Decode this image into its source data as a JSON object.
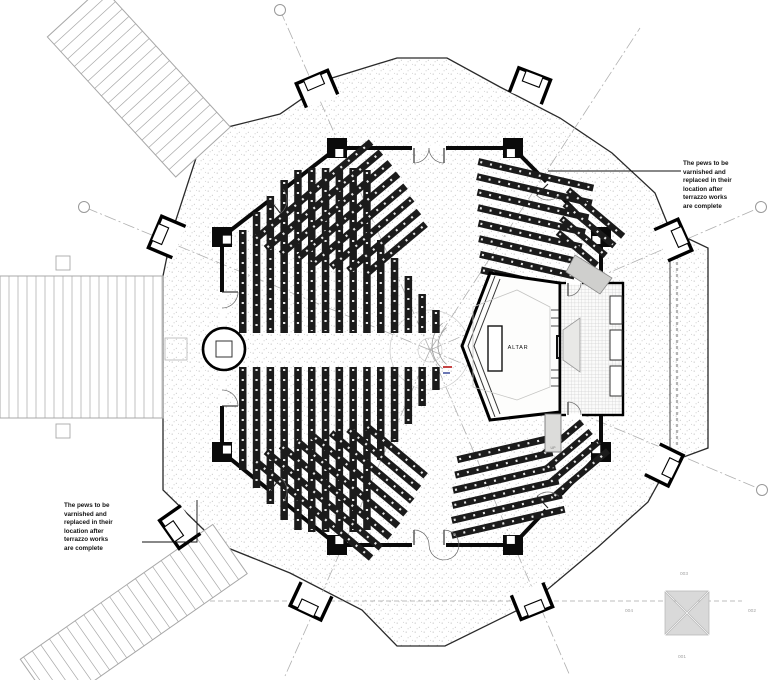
{
  "annotations": {
    "note_top_right": "The pews to be varnished and replaced in their location after terrazzo works are complete",
    "note_bottom_left": "The pews to be varnished and replaced in their location after terrazzo works are complete"
  },
  "labels": {
    "altar": "ALTAR",
    "up": "UP"
  },
  "ref_symbol": {
    "top": "003",
    "right": "002",
    "bottom": "001",
    "left": "004"
  },
  "colors": {
    "wall": "#0a0a0a",
    "outline": "#2a2a2a",
    "pew": "#1b1b1b",
    "stipple_dot": "#8f8f8f",
    "grey_line": "#a8a8a8",
    "dash_line": "#b0b0b0",
    "hatch": "#bcbcbc",
    "red_mark": "#c03030",
    "blue_mark": "#3a4a9a",
    "ref_fill": "#d9d9d9",
    "ref_edge": "#b5b5b5"
  },
  "drawing": {
    "canvas": {
      "w": 769,
      "h": 680
    },
    "center": [
      430,
      350
    ],
    "outer_boundary": [
      [
        397,
        58
      ],
      [
        447,
        58
      ],
      [
        500,
        87
      ],
      [
        560,
        118
      ],
      [
        612,
        153
      ],
      [
        655,
        193
      ],
      [
        670,
        230
      ],
      [
        708,
        248
      ],
      [
        708,
        448
      ],
      [
        670,
        462
      ],
      [
        648,
        502
      ],
      [
        598,
        547
      ],
      [
        548,
        589
      ],
      [
        516,
        611
      ],
      [
        445,
        646
      ],
      [
        397,
        646
      ],
      [
        362,
        610
      ],
      [
        290,
        573
      ],
      [
        228,
        548
      ],
      [
        205,
        531
      ],
      [
        163,
        490
      ],
      [
        163,
        418
      ],
      [
        163,
        276
      ],
      [
        172,
        232
      ],
      [
        197,
        155
      ],
      [
        228,
        127
      ],
      [
        280,
        114
      ],
      [
        332,
        78
      ]
    ],
    "porch_divider": [
      670,
      232,
      670,
      460
    ],
    "glazing_dash": [
      677,
      250,
      677,
      446
    ],
    "inner_octagon": [
      [
        337,
        148
      ],
      [
        513,
        148
      ],
      [
        601,
        237
      ],
      [
        601,
        452
      ],
      [
        513,
        545
      ],
      [
        337,
        545
      ],
      [
        222,
        452
      ],
      [
        222,
        237
      ]
    ],
    "wall_gaps": [
      [
        412,
        148,
        446,
        148
      ],
      [
        412,
        545,
        446,
        545
      ],
      [
        222,
        292,
        222,
        406
      ],
      [
        268,
        202,
        285,
        188
      ],
      [
        546,
        182,
        561,
        197
      ],
      [
        268,
        490,
        285,
        503
      ],
      [
        546,
        510,
        561,
        494
      ],
      [
        566,
        283,
        582,
        283
      ],
      [
        566,
        415,
        582,
        415
      ]
    ],
    "radial_lines": [
      [
        280,
        10
      ],
      [
        84,
        207
      ],
      [
        761,
        207
      ],
      [
        762,
        490
      ],
      [
        570,
        676
      ],
      [
        285,
        676
      ],
      [
        640,
        28
      ]
    ],
    "grid_markers": [
      [
        280,
        10
      ],
      [
        84,
        207
      ],
      [
        761,
        207
      ],
      [
        762,
        490
      ]
    ],
    "section_dash": [
      170,
      601,
      742,
      601
    ],
    "center_circles": [
      40,
      12
    ],
    "chancel_arcs": {
      "cx": 462,
      "cy": 346,
      "radii": [
        24,
        30
      ],
      "a1": 130,
      "a2": 230
    },
    "sanctuary": {
      "outline": [
        [
          462,
          346
        ],
        [
          490,
          273
        ],
        [
          560,
          283
        ],
        [
          560,
          412
        ],
        [
          490,
          420
        ]
      ],
      "steps": [
        [
          [
            495,
            276
          ],
          [
            468,
            346
          ],
          [
            495,
            417
          ]
        ],
        [
          [
            500,
            279
          ],
          [
            474,
            346
          ],
          [
            500,
            414
          ]
        ]
      ],
      "inner_hex": [
        [
          473,
          307
        ],
        [
          517,
          290
        ],
        [
          550,
          307
        ],
        [
          550,
          387
        ],
        [
          517,
          400
        ],
        [
          473,
          387
        ]
      ],
      "altar_rect": [
        488,
        326,
        14,
        45
      ],
      "tabernacle": [
        557,
        336,
        12,
        22
      ],
      "credence": [
        571,
        332,
        14,
        30
      ],
      "step_lines_y": [
        [
          310,
          318,
          326
        ],
        [
          370,
          378,
          386
        ]
      ],
      "marks": {
        "red": [
          443,
          367,
          9
        ],
        "blue": [
          443,
          371,
          7
        ]
      }
    },
    "sacristy": {
      "rect": [
        560,
        283,
        63,
        132
      ],
      "cupboards": [
        [
          610,
          296,
          12,
          28
        ],
        [
          610,
          330,
          12,
          30
        ],
        [
          610,
          366,
          12,
          30
        ]
      ],
      "niche": [
        [
          563,
          330
        ],
        [
          580,
          318
        ],
        [
          580,
          372
        ],
        [
          563,
          360
        ]
      ],
      "organ": [
        [
          575,
          255
        ],
        [
          612,
          278
        ],
        [
          600,
          294
        ],
        [
          566,
          272
        ]
      ],
      "up_ramp": [
        545,
        414,
        16,
        38
      ]
    },
    "font": {
      "cx": 224,
      "cy": 349,
      "r": 21,
      "sq": 16
    },
    "left_stairs": {
      "x": 0,
      "y": 276,
      "w": 163,
      "h": 142,
      "step": 9,
      "posts": [
        [
          56,
          256,
          14
        ],
        [
          56,
          424,
          14
        ]
      ],
      "landing": [
        165,
        338,
        22
      ]
    },
    "rot_stairs": [
      {
        "tx": 203,
        "ty": 152,
        "rot": -132.5,
        "len": 190,
        "halfw": 37,
        "step": 10
      },
      {
        "tx": 230,
        "ty": 549,
        "rot": 145,
        "len": 235,
        "halfw": 30,
        "step": 10.5
      }
    ],
    "vestibules": [
      {
        "x": 317,
        "y": 89,
        "rot": -23
      },
      {
        "x": 530,
        "y": 86,
        "rot": 21
      },
      {
        "x": 167,
        "y": 237,
        "rot": -67
      },
      {
        "x": 673,
        "y": 240,
        "rot": 66
      },
      {
        "x": 180,
        "y": 527,
        "rot": -125
      },
      {
        "x": 664,
        "y": 465,
        "rot": 116
      },
      {
        "x": 311,
        "y": 601,
        "rot": -155
      },
      {
        "x": 532,
        "y": 601,
        "rot": 158
      }
    ],
    "doors": [
      {
        "x": 414,
        "y": 148,
        "a0": 0,
        "a1": 90,
        "r": 15
      },
      {
        "x": 444,
        "y": 148,
        "a0": 180,
        "a1": 90,
        "r": 15
      },
      {
        "x": 414,
        "y": 545,
        "a0": 0,
        "a1": -90,
        "r": 15
      },
      {
        "x": 444,
        "y": 545,
        "a0": 180,
        "a1": -90,
        "r": 15
      },
      {
        "x": 222,
        "y": 292,
        "a0": 90,
        "a1": 0,
        "r": 16
      },
      {
        "x": 222,
        "y": 406,
        "a0": -90,
        "a1": 0,
        "r": 16
      },
      {
        "x": 270,
        "y": 200,
        "a0": -38,
        "a1": 52,
        "r": 17
      },
      {
        "x": 270,
        "y": 491,
        "a0": 39,
        "a1": -51,
        "r": 17
      },
      {
        "x": 548,
        "y": 184,
        "a0": 45,
        "a1": 135,
        "r": 16
      },
      {
        "x": 548,
        "y": 508,
        "a0": -47,
        "a1": -133,
        "r": 16
      },
      {
        "x": 568,
        "y": 283,
        "a0": 0,
        "a1": 90,
        "r": 13
      },
      {
        "x": 568,
        "y": 415,
        "a0": 0,
        "a1": -90,
        "r": 13
      }
    ],
    "pew_banks": {
      "columns": [
        {
          "x0": 239,
          "dx": 13.8,
          "w": 7.5,
          "base": 333,
          "dir": "up",
          "tops": [
            230,
            212,
            196,
            180,
            170,
            168,
            168,
            168,
            168,
            170,
            240,
            258,
            276,
            294,
            310
          ]
        },
        {
          "x0": 239,
          "dx": 13.8,
          "w": 7.5,
          "base": 367,
          "dir": "down",
          "tops": [
            470,
            488,
            504,
            520,
            530,
            532,
            532,
            532,
            532,
            530,
            460,
            442,
            424,
            406,
            390
          ]
        }
      ],
      "rotated": [
        {
          "tx": 352,
          "ty": 222,
          "rot": -40,
          "spacing": 14,
          "w": 7,
          "lens": [
            152,
            150,
            142,
            132,
            120,
            106,
            92,
            78
          ],
          "off": [
            -10,
            -8,
            -4,
            0,
            4,
            8,
            12,
            16
          ]
        },
        {
          "tx": 352,
          "ty": 478,
          "rot": 40,
          "spacing": 14,
          "w": 7,
          "lens": [
            78,
            92,
            106,
            120,
            132,
            142,
            150,
            152
          ],
          "off": [
            16,
            12,
            8,
            4,
            0,
            -4,
            -8,
            -10
          ]
        },
        {
          "tx": 524,
          "ty": 226,
          "rot": 13,
          "spacing": 15,
          "w": 7,
          "lens": [
            118,
            118,
            114,
            110,
            106,
            102,
            97,
            92
          ],
          "off": [
            0,
            2,
            4,
            6,
            8,
            10,
            12,
            14
          ]
        },
        {
          "tx": 500,
          "ty": 487,
          "rot": -13,
          "spacing": 14.5,
          "w": 7,
          "lens": [
            95,
            100,
            105,
            109,
            113,
            116
          ],
          "off": [
            12,
            9,
            6,
            4,
            2,
            0
          ]
        },
        {
          "tx": 583,
          "ty": 228,
          "rot": 40,
          "spacing": 13,
          "w": 6.5,
          "lens": [
            72,
            65,
            58,
            51
          ],
          "off": [
            0,
            3,
            6,
            9
          ]
        },
        {
          "tx": 568,
          "ty": 459,
          "rot": -40,
          "spacing": 13,
          "w": 6.5,
          "lens": [
            51,
            58,
            65,
            72
          ],
          "off": [
            9,
            6,
            3,
            0
          ]
        }
      ]
    },
    "ref_square": [
      663,
      589,
      48
    ],
    "leaders": [
      [
        [
          548,
          171
        ],
        [
          681,
          171
        ]
      ],
      [
        [
          142,
          542
        ],
        [
          197,
          542
        ],
        [
          197,
          500
        ]
      ]
    ]
  }
}
